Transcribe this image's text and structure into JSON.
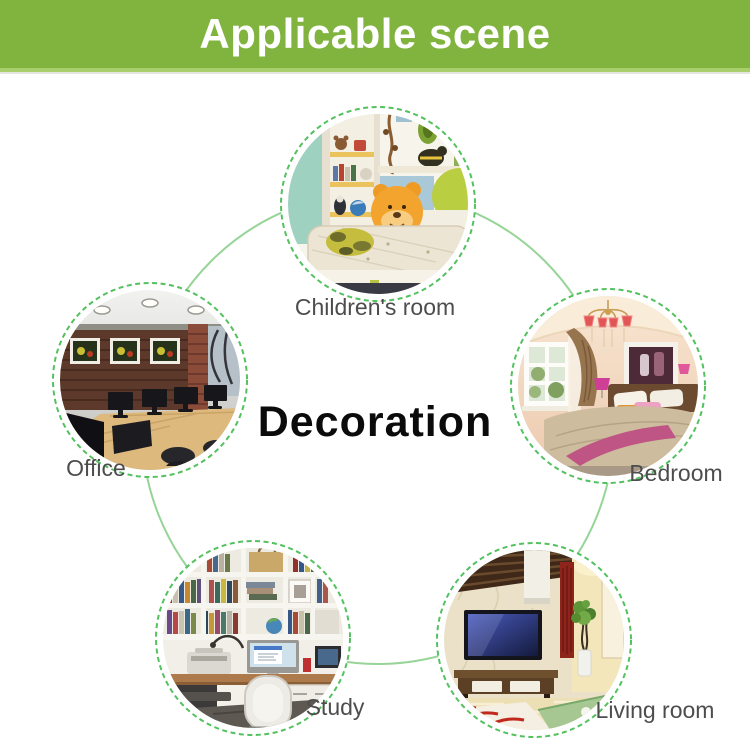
{
  "header": {
    "title": "Applicable scene",
    "bg_color": "#80b43e",
    "text_color": "#ffffff"
  },
  "diagram": {
    "center_label": "Decoration",
    "scenes": [
      {
        "id": "childrens-room",
        "label": "Children's room",
        "position": "top"
      },
      {
        "id": "office",
        "label": "Office",
        "position": "left"
      },
      {
        "id": "bedroom",
        "label": "Bedroom",
        "position": "right"
      },
      {
        "id": "study",
        "label": "Study",
        "position": "bottom-left"
      },
      {
        "id": "living-room",
        "label": "Living room",
        "position": "bottom-right"
      }
    ],
    "colors": {
      "dashed_ring": "#52c15e",
      "connector_circle": "#97d497",
      "label_text": "#4d4d4d",
      "center_text": "#0b0b0b"
    }
  }
}
